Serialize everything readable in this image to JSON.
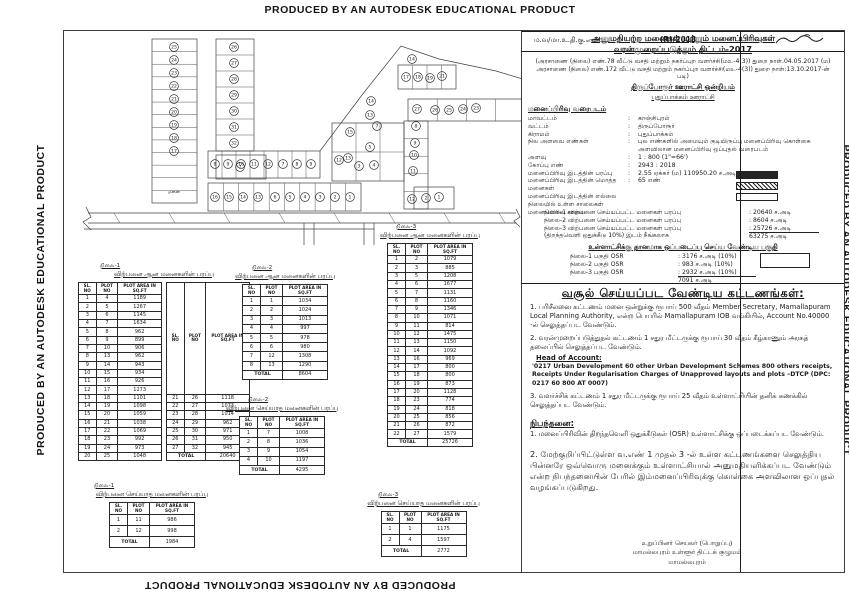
{
  "watermark": "PRODUCED BY AN AUTODESK EDUCATIONAL PRODUCT",
  "right_panel": {
    "title1": "அனுமதியற்ற மனைகள் மற்றும் மனைப்பிரிவுகள்",
    "title2": "வரன்முறைப்படுத்தும் திட்டம்-2017",
    "go_text": "(அரசாணை (நிலை) எண்.78 வீட்டு வசதி மற்றும் நகர்ப்புற வளர்ச்சி(மஉ-4(3)) துறை நாள்.04.05.2017 (ம) அரசாணை (நிலை) எண்.172 வீட்டு வசதி மற்றும் நகர்ப்புற வளர்ச்சி(மஉ-4(3)) துறை நாள்:13.10.2017-ன் படி)",
    "union": "திருப்போரூர் ஊராட்சி ஒன்றியம்",
    "panchayat": "புதுப்பாக்கம் ஊராட்சி",
    "map_heading": "மனைப்பிரிவு வரைபடம்",
    "details": [
      {
        "label": "மாவட்டம்",
        "value": "காஞ்சிபுரம்"
      },
      {
        "label": "வட்டம்",
        "value": "திருப்போரூர்"
      },
      {
        "label": "கிராமம்",
        "value": "புதுப்பாக்கம்"
      },
      {
        "label": "நில அளவை எண்கள்",
        "value": "புல எண்களில் அமையும் குடியிருப்பு மனைப்பிரிவு கொள்கை அளவிலான மனைப்பிரிவு ஒப்புதல் வரைபடம்"
      },
      {
        "label": "அளவு",
        "value": "1 : 800 (1\"=66')"
      },
      {
        "label": "கோப்பு எண்",
        "value": "2943 : 2018"
      },
      {
        "label": "மனைப்பிரிவு இடத்தின் பரப்பு",
        "value": "2.55 ஏக்கர் (ம) 110950.20 ச.அடி"
      },
      {
        "label": "மனைப்பிரிவு இடத்தின் மொத்த மனைகள்",
        "value": "65 எண்"
      }
    ],
    "legend": [
      {
        "label": "மனைப்பிரிவு இடத்தின் எல்லை",
        "swatch": "solid"
      },
      {
        "label": "நிலையில் உள்ள சாலைகள்",
        "swatch": "hatch"
      },
      {
        "label": "மனைப்பிரிவு சாலை",
        "swatch": "empty"
      }
    ],
    "sales": [
      {
        "label": "நிலை-1 விற்பனை செய்யப்பட்ட மனைகள் பரப்பு",
        "value": ": 20640 ச.அடி"
      },
      {
        "label": "நிலை-2 விற்பனை செய்யப்பட்ட மனைகள் பரப்பு",
        "value": ": 8604 ச.அடி"
      },
      {
        "label": "நிலை-3 விற்பனை செய்யப்பட்ட மனைகள் பரப்பு",
        "value": ": 25726 ச.அடி"
      },
      {
        "label": "(திறந்தவெளி ஒதுக்கீடு 10%) இடம் நீங்கலாக",
        "value": "63275 ச.அடி",
        "total": true
      }
    ],
    "osr_heading": "உள்ளாட்சிக்கு தானமாக ஒப்படைப்பு செய்ய வேண்டிய பகுதி",
    "osr_rows": [
      {
        "label": "நிலை-1 பகுதி OSR",
        "value": ": 3176 ச.அடி (10%)"
      },
      {
        "label": "நிலை-2 பகுதி OSR",
        "value": ": 983 ச.அடி (10%)"
      },
      {
        "label": "நிலை-3 பகுதி OSR",
        "value": ": 2932 ச.அடி (10%)"
      }
    ],
    "osr_total": "7091 ச.அடி",
    "fees_heading": "வசூல் செய்யப்பட வேண்டிய கட்டணங்கள்:",
    "fee1": "1. பரிசீலனை கட்டணம் மனை ஒன்றுக்கு ரூபாய் 500 வீதம் Member Secretary, Mamallapuram Local Planning Authority, என்ற பெயரில் Mamallapuram IOB வங்கியில், Account No.40000 -ல் செலுத்தப்பட வேண்டும்.",
    "fee2": "2. வரன்முறைப்படுத்துதல் கட்டணம் 1 சதுர மீட்டருக்கு ரூபாய் 30 வீதம் கீழ்காணும் அரசுத் தலைப்பில் செலுத்தப்பட வேண்டும்.",
    "hoa_label": "Head of Account:",
    "hoa_text": "'0217 Urban Development 60 other Urban Development Schemes 800 others receipts, Receipts Under Regularisation Charges of Unapproved layouts and plots –DTCP (DPC: 0217 60 800 AT 0007)",
    "fee3": "3. வளர்ச்சிக் கட்டணம் 1 சதுர மீட்டருக்கு ரூபாய் 25 வீதம் உள்ளாட்சியின் தனிக் கணக்கில் செலுத்தப்பட வேண்டும்.",
    "cond_heading": "நிபந்தனை:",
    "cond1": "1. மனைப்பிரிவின் திறந்தவெளி ஒதுக்கீடுகள் (OSR) உள்ளாட்சிக்கு ஒப்படைக்கப்பட வேண்டும்.",
    "cond2": "2. மேற்குறிப்பிட்டுள்ள வ.எண் 1 முதல் 3 -ல் உள்ள கட்டணங்களை செலுத்திய பின்னரே ஒவ்வொரு மனைக்கும் உள்ளாட்சியால் அனுமதியளிக்கப்பட வேண்டும் என்ற நிபந்தனையின் பேரில் இம்மனைப்பிரிவுக்கு கொள்கை அளவிலான ஒப்புதல் வழங்கப்படுகிறது.",
    "ref_label": "ம.வ/மா.உ.தி.கு.எண்:",
    "ref_value": "(R)/2018",
    "sig_line1": "உறுப்பினர் செயலர் (பொறுப்பு)",
    "sig_line2": "மாமல்லபுரம் உள்ளூர் திட்டக் குழுமம்",
    "sig_line3": "மாமல்லபுரம்"
  },
  "table_columns": [
    "SL. NO",
    "PLOT NO",
    "PLOT AREA IN SQ.FT"
  ],
  "tables": [
    {
      "phase": "நிலை-1",
      "title": "விற்பனை ஆன மனைகளின் பரப்பு",
      "total_label": "TOTAL",
      "total": "20640",
      "split_at": 20,
      "rows": [
        [
          "1",
          "4",
          "1189"
        ],
        [
          "2",
          "5",
          "1267"
        ],
        [
          "3",
          "6",
          "1145"
        ],
        [
          "4",
          "7",
          "1634"
        ],
        [
          "5",
          "8",
          "962"
        ],
        [
          "6",
          "9",
          "899"
        ],
        [
          "7",
          "10",
          "906"
        ],
        [
          "8",
          "13",
          "962"
        ],
        [
          "9",
          "14",
          "943"
        ],
        [
          "10",
          "15",
          "934"
        ],
        [
          "11",
          "16",
          "926"
        ],
        [
          "12",
          "17",
          "1273"
        ],
        [
          "13",
          "18",
          "1101"
        ],
        [
          "14",
          "19",
          "1098"
        ],
        [
          "15",
          "20",
          "1059"
        ],
        [
          "16",
          "21",
          "1038"
        ],
        [
          "17",
          "22",
          "1069"
        ],
        [
          "18",
          "23",
          "992"
        ],
        [
          "19",
          "24",
          "973"
        ],
        [
          "20",
          "25",
          "1048"
        ],
        [
          "21",
          "26",
          "1118"
        ],
        [
          "22",
          "27",
          "1073"
        ],
        [
          "23",
          "28",
          "1014"
        ],
        [
          "24",
          "29",
          "962"
        ],
        [
          "25",
          "30",
          "971"
        ],
        [
          "26",
          "31",
          "950"
        ],
        [
          "27",
          "32",
          "945"
        ]
      ]
    },
    {
      "phase": "நிலை-1",
      "title": "விற்பனை செய்யாத மனைகளின் பரப்பு",
      "total_label": "TOTAL",
      "total": "1984",
      "rows": [
        [
          "1",
          "11",
          "986"
        ],
        [
          "2",
          "12",
          "998"
        ]
      ]
    },
    {
      "phase": "நிலை-2",
      "title": "விற்பனை ஆன மனைகளின் பரப்பு",
      "total_label": "TOTAL",
      "total": "8604",
      "rows": [
        [
          "1",
          "1",
          "1034"
        ],
        [
          "2",
          "2",
          "1024"
        ],
        [
          "3",
          "3",
          "1013"
        ],
        [
          "4",
          "4",
          "997"
        ],
        [
          "5",
          "5",
          "978"
        ],
        [
          "6",
          "6",
          "980"
        ],
        [
          "7",
          "12",
          "1308"
        ],
        [
          "8",
          "13",
          "1290"
        ]
      ]
    },
    {
      "phase": "நிலை-2",
      "title": "விற்பனை செய்யாத மனைகளின் பரப்பு",
      "total_label": "TOTAL",
      "total": "4295",
      "rows": [
        [
          "1",
          "7",
          "1008"
        ],
        [
          "2",
          "8",
          "1036"
        ],
        [
          "3",
          "9",
          "1054"
        ],
        [
          "4",
          "10",
          "1197"
        ]
      ]
    },
    {
      "phase": "நிலை-3",
      "title": "விற்பனை ஆன மனைகளின் பரப்பு",
      "total_label": "TOTAL",
      "total": "25726",
      "rows": [
        [
          "1",
          "2",
          "1079"
        ],
        [
          "2",
          "3",
          "885"
        ],
        [
          "3",
          "5",
          "1208"
        ],
        [
          "4",
          "6",
          "1677"
        ],
        [
          "5",
          "7",
          "1131"
        ],
        [
          "6",
          "8",
          "1160"
        ],
        [
          "7",
          "9",
          "1346"
        ],
        [
          "8",
          "10",
          "1071"
        ],
        [
          "9",
          "11",
          "814"
        ],
        [
          "10",
          "12",
          "1475"
        ],
        [
          "11",
          "13",
          "1150"
        ],
        [
          "12",
          "14",
          "1092"
        ],
        [
          "13",
          "16",
          "969"
        ],
        [
          "14",
          "17",
          "800"
        ],
        [
          "15",
          "18",
          "800"
        ],
        [
          "16",
          "19",
          "873"
        ],
        [
          "17",
          "20",
          "1128"
        ],
        [
          "18",
          "23",
          "774"
        ],
        [
          "19",
          "24",
          "818"
        ],
        [
          "20",
          "25",
          "856"
        ],
        [
          "21",
          "26",
          "872"
        ],
        [
          "22",
          "27",
          "1579"
        ]
      ]
    },
    {
      "phase": "நிலை-3",
      "title": "விற்பனை செய்யாத மனைகளின் பரப்பு",
      "total_label": "TOTAL",
      "total": "2772",
      "rows": [
        [
          "1",
          "1",
          "1175"
        ],
        [
          "2",
          "4",
          "1597"
        ]
      ]
    }
  ],
  "site_plan": {
    "area_label": "மனை",
    "plot_labels": {
      "strip1": [
        "25",
        "24",
        "23",
        "22",
        "21",
        "20",
        "19",
        "18",
        "17"
      ],
      "strip2": [
        "26",
        "27",
        "28",
        "29",
        "30",
        "31",
        "32"
      ],
      "plot7": [
        "7"
      ],
      "band_top": [
        "8",
        "9",
        "10",
        "11",
        "12",
        "7",
        "8",
        "9"
      ],
      "band_bottom": [
        "16",
        "15",
        "14",
        "13",
        "6",
        "5",
        "4",
        "3",
        "2",
        "1"
      ],
      "right": [
        "14",
        "17",
        "18",
        "19",
        "21",
        "27",
        "26",
        "25",
        "24",
        "23",
        "8",
        "9",
        "10",
        "11",
        "12",
        "14",
        "13",
        "7",
        "15",
        "5",
        "13",
        "12",
        "3",
        "4",
        "2",
        "1"
      ]
    }
  }
}
